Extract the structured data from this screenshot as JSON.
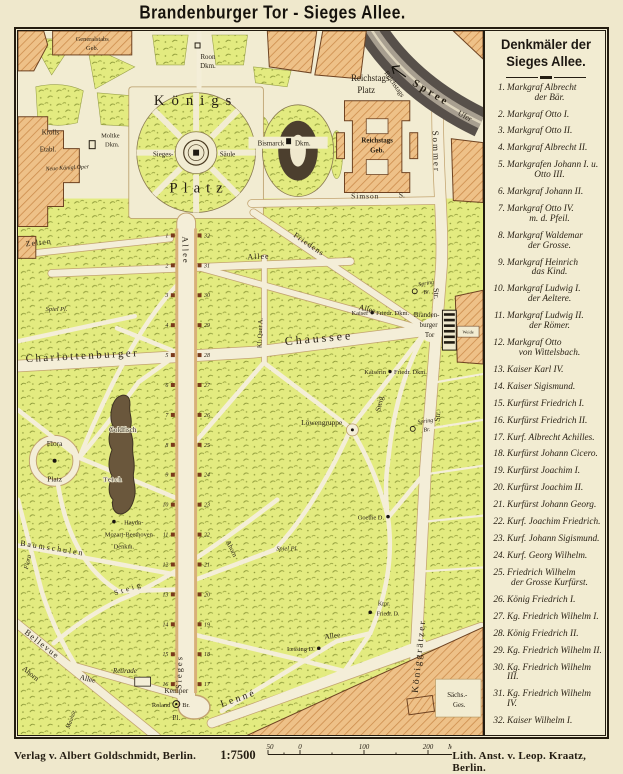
{
  "title": "Brandenburger Tor - Sieges Allee.",
  "legend": {
    "title1": "Denkmäler der",
    "title2": "Sieges Allee.",
    "items": [
      {
        "n": "1.",
        "l1": "Markgraf Albrecht",
        "l2": "der Bär."
      },
      {
        "n": "2.",
        "l1": "Markgraf Otto I."
      },
      {
        "n": "3.",
        "l1": "Markgraf Otto II."
      },
      {
        "n": "4.",
        "l1": "Markgraf Albrecht II."
      },
      {
        "n": "5.",
        "l1": "Markgrafen Johann I. u.",
        "l2": "Otto III."
      },
      {
        "n": "6.",
        "l1": "Markgraf Johann II."
      },
      {
        "n": "7.",
        "l1": "Markgraf Otto IV.",
        "l2": "m. d. Pfeil."
      },
      {
        "n": "8.",
        "l1": "Markgraf Waldemar",
        "l2": "der Grosse."
      },
      {
        "n": "9.",
        "l1": "Markgraf Heinrich",
        "l2": "das Kind."
      },
      {
        "n": "10.",
        "l1": "Markgraf Ludwig I.",
        "l2": "der Aeltere."
      },
      {
        "n": "11.",
        "l1": "Markgraf Ludwig II.",
        "l2": "der Römer."
      },
      {
        "n": "12.",
        "l1": "Markgraf Otto",
        "l2": "von Wittelsbach."
      },
      {
        "n": "13.",
        "l1": "Kaiser Karl IV."
      },
      {
        "n": "14.",
        "l1": "Kaiser Sigismund."
      },
      {
        "n": "15.",
        "l1": "Kurfürst Friedrich I."
      },
      {
        "n": "16.",
        "l1": "Kurfürst Friedrich II."
      },
      {
        "n": "17.",
        "l1": "Kurf. Albrecht Achilles."
      },
      {
        "n": "18.",
        "l1": "Kurfürst Johann Cicero."
      },
      {
        "n": "19.",
        "l1": "Kurfürst Joachim I."
      },
      {
        "n": "20.",
        "l1": "Kurfürst Joachim II."
      },
      {
        "n": "21.",
        "l1": "Kurfürst Johann Georg."
      },
      {
        "n": "22.",
        "l1": "Kurf. Joachim Friedrich."
      },
      {
        "n": "23.",
        "l1": "Kurf. Johann Sigismund."
      },
      {
        "n": "24.",
        "l1": "Kurf. Georg Wilhelm."
      },
      {
        "n": "25.",
        "l1": "Friedrich Wilhelm",
        "l2": "der Grosse Kurfürst."
      },
      {
        "n": "26.",
        "l1": "König Friedrich I."
      },
      {
        "n": "27.",
        "l1": "Kg. Friedrich Wilhelm I."
      },
      {
        "n": "28.",
        "l1": "König Friedrich II."
      },
      {
        "n": "29.",
        "l1": "Kg. Friedrich Wilhelm II."
      },
      {
        "n": "30.",
        "l1": "Kg. Friedrich Wilhelm III."
      },
      {
        "n": "31.",
        "l1": "Kg. Friedrich Wilhelm IV."
      },
      {
        "n": "32.",
        "l1": "Kaiser Wilhelm I."
      }
    ]
  },
  "map": {
    "west_numbers": [
      "1",
      "2",
      "3",
      "4",
      "5",
      "6",
      "7",
      "8",
      "9",
      "10",
      "11",
      "12",
      "13",
      "14",
      "15",
      "16"
    ],
    "east_numbers": [
      "32",
      "31",
      "30",
      "29",
      "28",
      "27",
      "26",
      "25",
      "24",
      "23",
      "22",
      "21",
      "20",
      "19",
      "18",
      "17"
    ],
    "labels": {
      "generalstabs1": "Generalstabs",
      "generalstabs2": "Geb.",
      "roon1": "Roon",
      "roon2": "Dkm.",
      "koenigs": "Königs",
      "platz": "Platz",
      "krolls1": "Krolls",
      "krolls2": "Etabl.",
      "neue_oper": "Neue Königl.Oper",
      "moltke1": "Moltke",
      "moltke2": "Dkm.",
      "sieges_saeule1": "Sieges-",
      "sieges_saeule2": "Säule",
      "bismarck1": "Bismarck",
      "bismarck2": "Dkm.",
      "reichstags_platz1": "Reichstags",
      "reichstags_platz2": "Platz",
      "reichstags_geb1": "Reichstags",
      "reichstags_geb2": "Geb.",
      "simson1": "Simson",
      "simson2": "S.",
      "spree": "Spree",
      "ufer1": "Reichstags",
      "ufer2": "Ufer",
      "sommer": "Sommer",
      "sommer_str": "Str.",
      "zelten": "Zelten",
      "allee_vertical": "Allee",
      "allee_horizontal": "Allee",
      "friedens": "Friedens",
      "allee_diagonal": "Allee",
      "kl_quer": "Kl. Quer A.",
      "spiel_pl_nw": "Spiel Pl.",
      "spiel_pl_s": "Spiel Pl.",
      "kaiser1": "Kaiser",
      "kaiser2": "Friedr. Dkm.",
      "kaiserin1": "Kaiserin",
      "kaiserin2": "Friedr. Dkm.",
      "brandenburger1": "Branden-",
      "brandenburger2": "burger",
      "brandenburger3": "Tor",
      "charlottenburger": "Charlottenburger",
      "chaussee": "Chaussee",
      "spring_n1": "Spring",
      "spring_n2": "Br.",
      "spring_s1": "Spring",
      "spring_s2": "Br.",
      "steig_vertical": "Steig",
      "steig_diagonal": "Steig",
      "koeniggr_str_short": "Str.",
      "flora1": "Flora",
      "flora2": "Platz",
      "flora_street": "Flora",
      "goldfisch": "Goldfisch",
      "teich": "Teich",
      "loewengruppe": "Löwengruppe",
      "goethe": "Goethe D.",
      "haydn1": "Haydn-",
      "haydn2": "Mozart-Beethoven",
      "haydn3": "Denkm.",
      "baumschulen": "Baumschulen",
      "ahorn_mid": "Ahorn",
      "ahorn_sw": "Ahorn",
      "sieges_street": "Sieges",
      "lessing": "Lessing D.",
      "kronprinz1": "Krpr.",
      "kronprinz2": "Friedr. D.",
      "koeniggraetzer": "Königgrätzer",
      "saechs1": "Sächs.-",
      "saechs2": "Ges.",
      "bellevue": "Bellevue",
      "retirade": "Retirade",
      "allee_sw": "Allee",
      "allee_se": "Allee",
      "kemper1": "Kemper",
      "kemper2": "Pl.",
      "roland1": "Roland",
      "roland2": "Br.",
      "lenne": "Lenné",
      "weide": "Weide",
      "mauthuet": "Mauhüt."
    }
  },
  "footer": {
    "verlag": "Verlag v. Albert Goldschmidt, Berlin.",
    "scale_ratio": "1:7500",
    "ticks": [
      "50",
      "0",
      "100",
      "200"
    ],
    "unit": "Meter",
    "lith": "Lith. Anst. v. Leop. Kraatz, Berlin."
  },
  "colors": {
    "paper": "#f2ecd2",
    "park": "#e3eb80",
    "building": "#eec188",
    "river": "#57504a",
    "ink": "#241d12",
    "monument": "#7a3a1c"
  }
}
